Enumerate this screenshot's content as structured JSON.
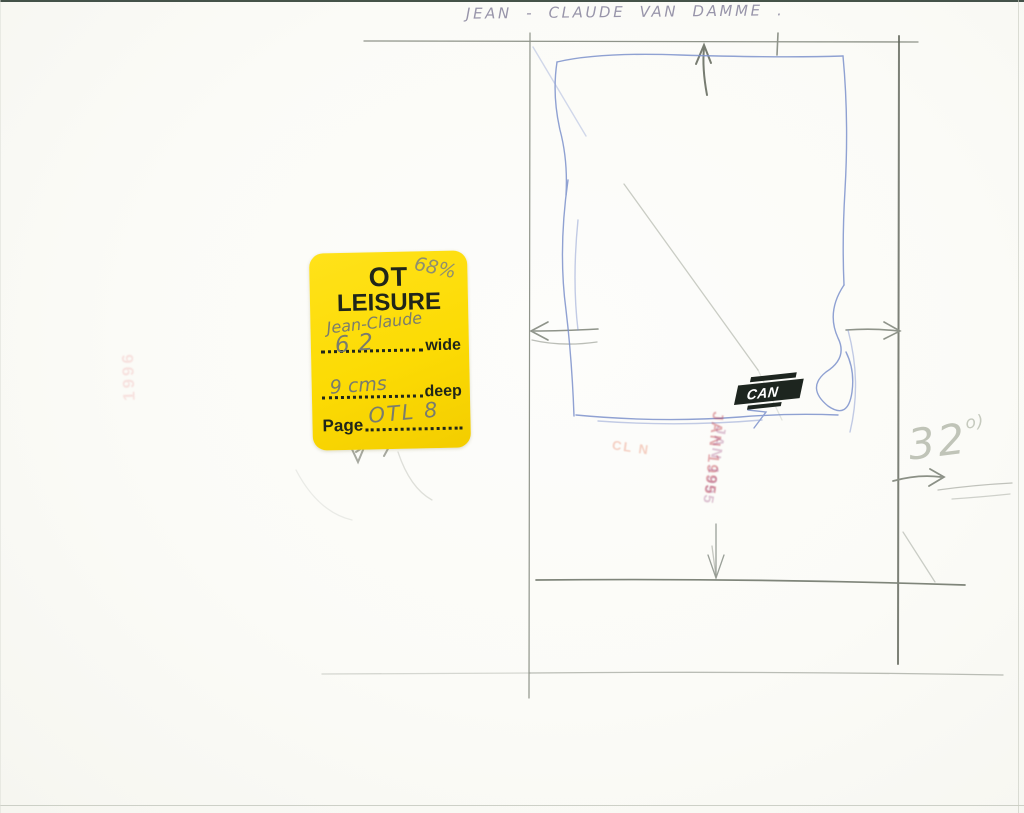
{
  "caption": "JEAN - CLAUDE VAN DAMME .",
  "sticker": {
    "brand_line1": "OT",
    "brand_line2": "LEISURE",
    "wide_label": "wide",
    "deep_label": "deep",
    "page_label": "Page",
    "handwritten_name": "Jean-Claude",
    "handwritten_width": "62",
    "handwritten_depth": "9 cms",
    "handwritten_page": "OTL 8",
    "handwritten_scale": "68%"
  },
  "annotations": {
    "size_note": "32",
    "size_note_sup": "o)"
  },
  "stamps": {
    "center_line": "JAN 1995",
    "center_side": "CL N",
    "left_faint": "1996"
  },
  "press_label": "CAN",
  "colors": {
    "sticker_yellow": "#fcdb04",
    "pencil_gray": "#8f948a",
    "pencil_dark": "#5c6156",
    "pen_blue": "#7d92cc",
    "stamp_red": "#c13e4b",
    "label_black": "#1d251f",
    "caption_ink": "#8e8aa2",
    "paper": "#fbfbf7"
  }
}
